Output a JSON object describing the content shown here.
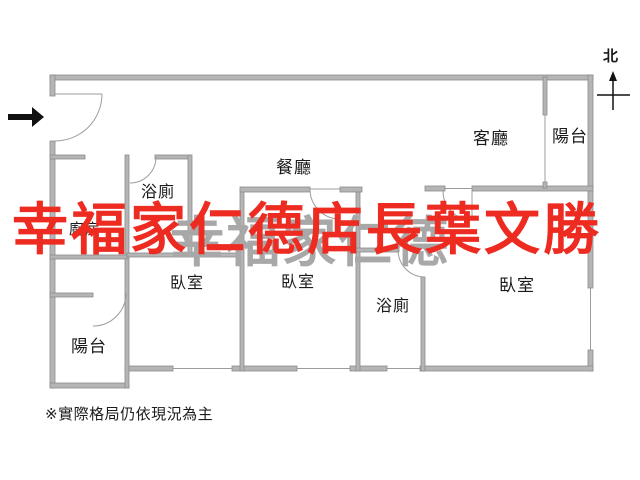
{
  "title": "apartment-floor-plan",
  "rooms": {
    "living": "客廳",
    "dining": "餐廳",
    "kitchen": "廚房",
    "bath_upper": "浴廁",
    "bath_lower": "浴廁",
    "bedroom_left": "臥室",
    "bedroom_middle": "臥室",
    "bedroom_right": "臥室",
    "balcony_top_right": "陽台",
    "balcony_bottom_left": "陽台"
  },
  "compass": {
    "north_label": "北"
  },
  "watermark": {
    "red_text": "幸福家仁德店長葉文勝",
    "gray_text": "幸福家仁德"
  },
  "note": "※實際格局仍依現況為主",
  "colors": {
    "wall_fill": "#b5b5b5",
    "wall_edge": "#8c8c8c",
    "line": "#9c9c9c",
    "label": "#1a1a1a",
    "arrow": "#111111",
    "red_wm": "#ed2b21",
    "gray_wm": "#a8a8a8"
  }
}
